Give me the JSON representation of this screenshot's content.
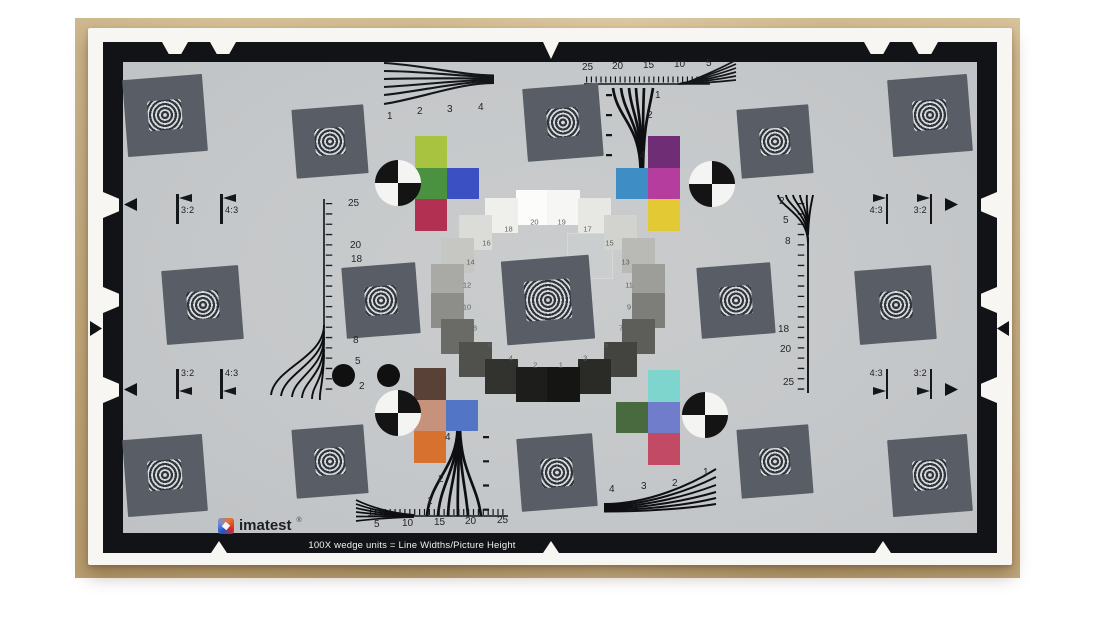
{
  "photo": {
    "wood_color": "#c9af80",
    "paper_color": "#f7f6f2",
    "description": "imatest eSFR ISO test chart photographed on wooden table"
  },
  "chart": {
    "background": "#c5c8ca",
    "border_color": "#121316",
    "square_fill": "#585d66",
    "footer_text": "100X wedge units = Line Widths/Picture Height",
    "brand": {
      "name": "imatest",
      "mark": "®"
    },
    "rulers": {
      "top": [
        "25",
        "20",
        "15",
        "10",
        "5"
      ],
      "bottom": [
        "5",
        "10",
        "15",
        "20",
        "25"
      ],
      "left": [
        "25",
        "20",
        "18",
        "8",
        "5",
        "2"
      ],
      "right": [
        "2",
        "5",
        "8",
        "18",
        "20",
        "25"
      ]
    },
    "wedge_labels": {
      "top_left": [
        "1",
        "2",
        "3",
        "4"
      ],
      "top_center": [
        "1",
        "2",
        "4"
      ],
      "bottom_center": [
        "4",
        "2",
        "1"
      ],
      "bottom_right": [
        "4",
        "3",
        "2",
        "1"
      ]
    },
    "aspect_markers": {
      "top_left": [
        "3:2",
        "4:3"
      ],
      "top_right": [
        "4:3",
        "3:2"
      ],
      "bottom_left": [
        "3:2",
        "4:3"
      ],
      "bottom_right": [
        "4:3",
        "3:2"
      ]
    },
    "grayscale_ring": [
      {
        "n": "20",
        "color": "#fcfcfa"
      },
      {
        "n": "19",
        "color": "#f6f6f4"
      },
      {
        "n": "18",
        "color": "#efefec"
      },
      {
        "n": "17",
        "color": "#e7e7e4"
      },
      {
        "n": "16",
        "color": "#dbdbd8"
      },
      {
        "n": "15",
        "color": "#d2d2cf"
      },
      {
        "n": "14",
        "color": "#c6c6c3"
      },
      {
        "n": "13",
        "color": "#b9b9b6"
      },
      {
        "n": "12",
        "color": "#a9a9a6"
      },
      {
        "n": "11",
        "color": "#9d9d9a"
      },
      {
        "n": "10",
        "color": "#8d8d8a"
      },
      {
        "n": "9",
        "color": "#7d7d7a"
      },
      {
        "n": "8",
        "color": "#6a6a67"
      },
      {
        "n": "7",
        "color": "#5d5d5a"
      },
      {
        "n": "6",
        "color": "#50504d"
      },
      {
        "n": "5",
        "color": "#434340"
      },
      {
        "n": "4",
        "color": "#32322f"
      },
      {
        "n": "3",
        "color": "#2a2a27"
      },
      {
        "n": "2",
        "color": "#1d1d1b"
      },
      {
        "n": "1",
        "color": "#151513"
      }
    ],
    "color_patches": {
      "top_left": [
        {
          "name": "yellow-green",
          "color": "#a8c340",
          "col": 0,
          "row": 0
        },
        {
          "name": "green",
          "color": "#4a9140",
          "col": 0,
          "row": 1
        },
        {
          "name": "blue",
          "color": "#3b50c3",
          "col": 1,
          "row": 1
        },
        {
          "name": "crimson",
          "color": "#b23051",
          "col": 0,
          "row": 2
        }
      ],
      "top_right": [
        {
          "name": "purple",
          "color": "#6e2d74",
          "col": 1,
          "row": 0
        },
        {
          "name": "cyan-blue",
          "color": "#3e8dc5",
          "col": 0,
          "row": 1
        },
        {
          "name": "magenta",
          "color": "#b43d9e",
          "col": 1,
          "row": 1
        },
        {
          "name": "yellow",
          "color": "#e3ca34",
          "col": 1,
          "row": 2
        }
      ],
      "bottom_left": [
        {
          "name": "dark-brown",
          "color": "#594138",
          "col": 0,
          "row": 0
        },
        {
          "name": "tan",
          "color": "#c6927b",
          "col": 0,
          "row": 1
        },
        {
          "name": "medium-blue",
          "color": "#5275c5",
          "col": 1,
          "row": 1
        },
        {
          "name": "orange",
          "color": "#d7712f",
          "col": 0,
          "row": 2
        }
      ],
      "bottom_right": [
        {
          "name": "aqua",
          "color": "#7ed5cd",
          "col": 1,
          "row": 0
        },
        {
          "name": "olive-green",
          "color": "#49693e",
          "col": 0,
          "row": 1
        },
        {
          "name": "periwinkle",
          "color": "#6f7dca",
          "col": 1,
          "row": 1
        },
        {
          "name": "crimson",
          "color": "#c34a65",
          "col": 1,
          "row": 2
        }
      ]
    }
  }
}
